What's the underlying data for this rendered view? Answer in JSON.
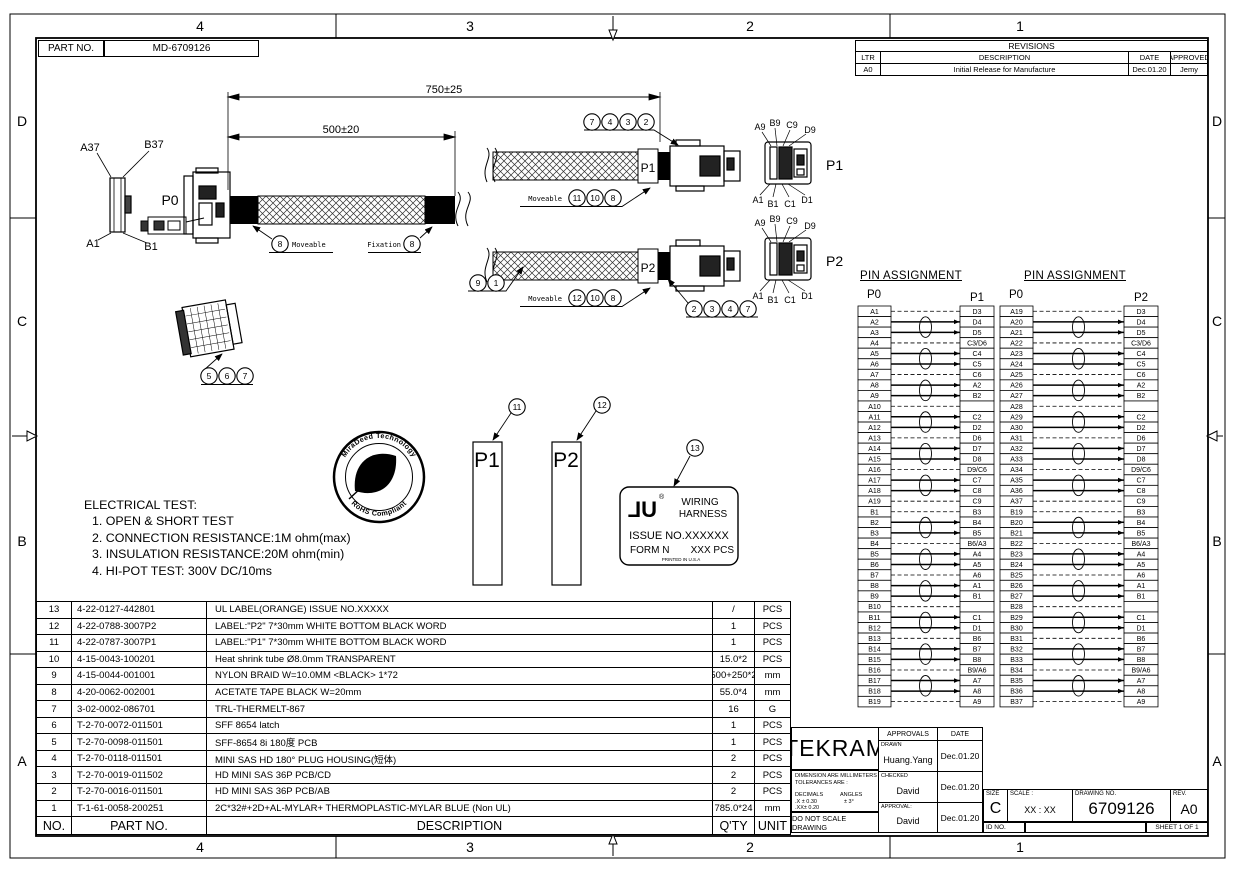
{
  "sheet": {
    "zones_cols": [
      "4",
      "3",
      "2",
      "1"
    ],
    "zones_rows": [
      "D",
      "C",
      "B",
      "A"
    ],
    "part_no": {
      "label": "PART NO.",
      "value": "MD-6709126"
    }
  },
  "revisions": {
    "title": "REVISIONS",
    "headers": [
      "LTR",
      "DESCRIPTION",
      "DATE",
      "APPROVED"
    ],
    "rows": [
      {
        "ltr": "A0",
        "description": "Initial Release for Manufacture",
        "date": "Dec.01.20",
        "approved": "Jemy"
      }
    ]
  },
  "drawing": {
    "dims": {
      "overall": "750±25",
      "inner": "500±20"
    },
    "p0_view": {
      "label": "P0",
      "pin_tl": "A37",
      "pin_tr": "B37",
      "pin_bl": "A1",
      "pin_br": "B1"
    },
    "p1_view": {
      "label": "P1",
      "pins_top": [
        "A9",
        "B9",
        "C9",
        "D9"
      ],
      "pins_bottom": [
        "A1",
        "B1",
        "C1",
        "D1"
      ]
    },
    "p2_view": {
      "label": "P2",
      "pins_top": [
        "A9",
        "B9",
        "C9",
        "D9"
      ],
      "pins_bottom": [
        "A1",
        "B1",
        "C1",
        "D1"
      ]
    },
    "tags": {
      "p1": "P1",
      "p2": "P2"
    },
    "callout_text": {
      "moveable": "Moveable",
      "fixation": "Fixation"
    },
    "balloons": {
      "p1_top": [
        "7",
        "4",
        "3",
        "2"
      ],
      "p1_bottom": [
        "11",
        "10",
        "8"
      ],
      "main_moveable": "8",
      "main_fixation": "8",
      "p2_start": [
        "9",
        "1"
      ],
      "p2_bottom": [
        "12",
        "10",
        "8"
      ],
      "p2_conn": [
        "2",
        "3",
        "4",
        "7"
      ],
      "small_parts": [
        "5",
        "6",
        "7"
      ],
      "label_p1": "11",
      "label_p2": "12",
      "ul_label": "13"
    },
    "stamp": {
      "arc_top": "MiraDeed Technology",
      "arc_bottom": "RoHS Compliant"
    },
    "ul_label": {
      "logo": "UL",
      "reg": "®",
      "line1": "WIRING",
      "line2": "HARNESS",
      "issue": "ISSUE NO.XXXXXX",
      "form": "FORM N",
      "qty": "XXX PCS",
      "printed": "PRINTED IN U.S.A"
    },
    "label_rects": {
      "p1": "P1",
      "p2": "P2"
    },
    "electrical_test": [
      "ELECTRICAL TEST:",
      "1. OPEN & SHORT TEST",
      "2. CONNECTION RESISTANCE:1M ohm(max)",
      "3. INSULATION RESISTANCE:20M ohm(min)",
      "4. HI-POT TEST: 300V DC/10ms"
    ]
  },
  "pin_assignment": {
    "title": "PIN ASSIGNMENT",
    "tables": [
      {
        "left_header": "P0",
        "right_header": "P1",
        "rows": [
          [
            "A1",
            "D3"
          ],
          [
            "A2",
            "D4"
          ],
          [
            "A3",
            "D5"
          ],
          [
            "A4",
            "C3/D6"
          ],
          [
            "A5",
            "C4"
          ],
          [
            "A6",
            "C5"
          ],
          [
            "A7",
            "C6"
          ],
          [
            "A8",
            "A2"
          ],
          [
            "A9",
            "B2"
          ],
          [
            "A10",
            ""
          ],
          [
            "A11",
            "C2"
          ],
          [
            "A12",
            "D2"
          ],
          [
            "A13",
            "D6"
          ],
          [
            "A14",
            "D7"
          ],
          [
            "A15",
            "D8"
          ],
          [
            "A16",
            "D9/C6"
          ],
          [
            "A17",
            "C7"
          ],
          [
            "A18",
            "C8"
          ],
          [
            "A19",
            "C9"
          ],
          [
            "B1",
            "B3"
          ],
          [
            "B2",
            "B4"
          ],
          [
            "B3",
            "B5"
          ],
          [
            "B4",
            "B6/A3"
          ],
          [
            "B5",
            "A4"
          ],
          [
            "B6",
            "A5"
          ],
          [
            "B7",
            "A6"
          ],
          [
            "B8",
            "A1"
          ],
          [
            "B9",
            "B1"
          ],
          [
            "B10",
            ""
          ],
          [
            "B11",
            "C1"
          ],
          [
            "B12",
            "D1"
          ],
          [
            "B13",
            "B6"
          ],
          [
            "B14",
            "B7"
          ],
          [
            "B15",
            "B8"
          ],
          [
            "B16",
            "B9/A6"
          ],
          [
            "B17",
            "A7"
          ],
          [
            "B18",
            "A8"
          ],
          [
            "B19",
            "A9"
          ]
        ]
      },
      {
        "left_header": "P0",
        "right_header": "P2",
        "rows": [
          [
            "A19",
            "D3"
          ],
          [
            "A20",
            "D4"
          ],
          [
            "A21",
            "D5"
          ],
          [
            "A22",
            "C3/D6"
          ],
          [
            "A23",
            "C4"
          ],
          [
            "A24",
            "C5"
          ],
          [
            "A25",
            "C6"
          ],
          [
            "A26",
            "A2"
          ],
          [
            "A27",
            "B2"
          ],
          [
            "A28",
            ""
          ],
          [
            "A29",
            "C2"
          ],
          [
            "A30",
            "D2"
          ],
          [
            "A31",
            "D6"
          ],
          [
            "A32",
            "D7"
          ],
          [
            "A33",
            "D8"
          ],
          [
            "A34",
            "D9/C6"
          ],
          [
            "A35",
            "C7"
          ],
          [
            "A36",
            "C8"
          ],
          [
            "A37",
            "C9"
          ],
          [
            "B19",
            "B3"
          ],
          [
            "B20",
            "B4"
          ],
          [
            "B21",
            "B5"
          ],
          [
            "B22",
            "B6/A3"
          ],
          [
            "B23",
            "A4"
          ],
          [
            "B24",
            "A5"
          ],
          [
            "B25",
            "A6"
          ],
          [
            "B26",
            "A1"
          ],
          [
            "B27",
            "B1"
          ],
          [
            "B28",
            ""
          ],
          [
            "B29",
            "C1"
          ],
          [
            "B30",
            "D1"
          ],
          [
            "B31",
            "B6"
          ],
          [
            "B32",
            "B7"
          ],
          [
            "B33",
            "B8"
          ],
          [
            "B34",
            "B9/A6"
          ],
          [
            "B35",
            "A7"
          ],
          [
            "B36",
            "A8"
          ],
          [
            "B37",
            "A9"
          ]
        ]
      }
    ]
  },
  "bom": {
    "headers": {
      "no": "NO.",
      "part": "PART NO.",
      "desc": "DESCRIPTION",
      "qty": "Q'TY",
      "unit": "UNIT"
    },
    "rows": [
      {
        "no": "13",
        "part": "4-22-0127-442801",
        "desc": "UL LABEL(ORANGE) ISSUE NO.XXXXX",
        "qty": "/",
        "unit": "PCS"
      },
      {
        "no": "12",
        "part": "4-22-0788-3007P2",
        "desc": "LABEL:\"P2\" 7*30mm WHITE BOTTOM BLACK WORD",
        "qty": "1",
        "unit": "PCS"
      },
      {
        "no": "11",
        "part": "4-22-0787-3007P1",
        "desc": "LABEL:\"P1\" 7*30mm WHITE BOTTOM BLACK WORD",
        "qty": "1",
        "unit": "PCS"
      },
      {
        "no": "10",
        "part": "4-15-0043-100201",
        "desc": "Heat shrink tube Ø8.0mm TRANSPARENT",
        "qty": "15.0*2",
        "unit": "PCS"
      },
      {
        "no": "9",
        "part": "4-15-0044-001001",
        "desc": "NYLON BRAID W=10.0MM <BLACK> 1*72",
        "qty": "500+250*2",
        "unit": "mm"
      },
      {
        "no": "8",
        "part": "4-20-0062-002001",
        "desc": "ACETATE TAPE BLACK W=20mm",
        "qty": "55.0*4",
        "unit": "mm"
      },
      {
        "no": "7",
        "part": "3-02-0002-086701",
        "desc": "TRL-THERMELT-867",
        "qty": "16",
        "unit": "G"
      },
      {
        "no": "6",
        "part": "T-2-70-0072-011501",
        "desc": "SFF 8654 latch",
        "qty": "1",
        "unit": "PCS"
      },
      {
        "no": "5",
        "part": "T-2-70-0098-011501",
        "desc": "SFF-8654 8i 180度 PCB",
        "qty": "1",
        "unit": "PCS"
      },
      {
        "no": "4",
        "part": "T-2-70-0118-011501",
        "desc": "MINI SAS HD 180° PLUG HOUSING(短体)",
        "qty": "2",
        "unit": "PCS"
      },
      {
        "no": "3",
        "part": "T-2-70-0019-011502",
        "desc": "HD MINI SAS 36P PCB/CD",
        "qty": "2",
        "unit": "PCS"
      },
      {
        "no": "2",
        "part": "T-2-70-0016-011501",
        "desc": "HD MINI SAS 36P PCB/AB",
        "qty": "2",
        "unit": "PCS"
      },
      {
        "no": "1",
        "part": "T-1-61-0058-200251",
        "desc": "2C*32#+2D+AL-MYLAR+ THERMOPLASTIC-MYLAR BLUE (Non UL)",
        "qty": "785.0*24",
        "unit": "mm"
      }
    ]
  },
  "title_block": {
    "company": "TEKRAM",
    "dim_note1": "DIMENSION ARE MILLIMETERS",
    "dim_note2": "TOLERANCES ARE :",
    "decimals_label": "DECIMALS",
    "angles_label": "ANGLES",
    "dec1": ".X  ± 0.30",
    "ang1": "± 3°",
    "dec2": ".XX±  0.20",
    "do_not_scale": "DO NOT SCALE DRAWING",
    "approvals_header": "APPROVALS",
    "date_header": "DATE",
    "rows": [
      {
        "role": "DRAWN",
        "name": "Huang.Yang",
        "date": "Dec.01.20"
      },
      {
        "role": "CHECKED",
        "name": "David",
        "date": "Dec.01.20"
      },
      {
        "role": "APPROVAL:",
        "name": "David",
        "date": "Dec.01.20"
      }
    ],
    "size_label": "SIZE",
    "size": "C",
    "scale_label": "SCALE :",
    "scale": "XX : XX",
    "drawing_no_label": "DRAWING  NO.",
    "drawing_no": "6709126",
    "rev_label": "REV.",
    "rev": "A0",
    "id_label": "ID NO.",
    "sheet": "SHEET 1 OF 1"
  }
}
